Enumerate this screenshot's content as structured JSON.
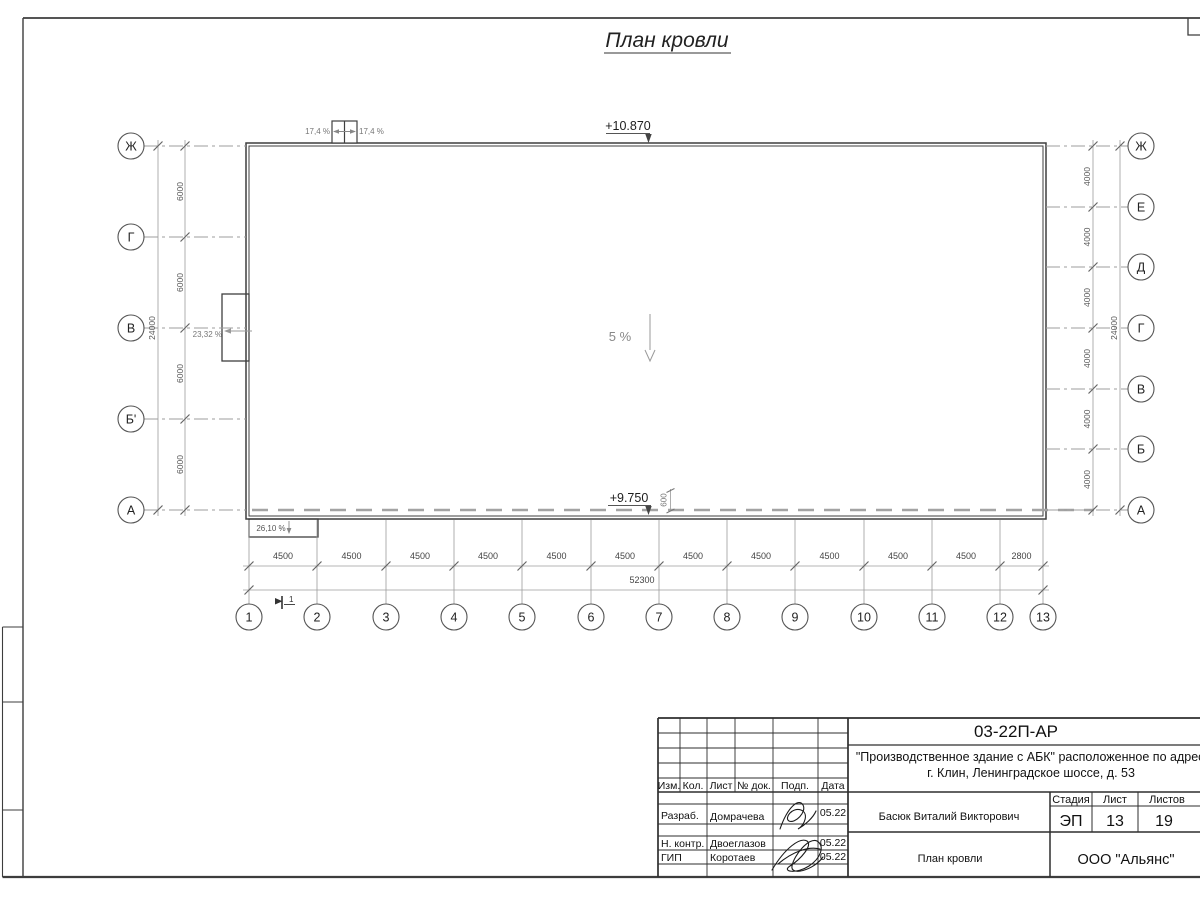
{
  "page_title": "План кровли",
  "plan": {
    "elevations": {
      "roof_top": "+10.870",
      "roof_low": "+9.750"
    },
    "slopes": {
      "hatch_left": "17,4 %",
      "hatch_right": "17,4 %",
      "west_wall": "23,32 %",
      "canopy": "26,10 %",
      "main_roof": "5 %"
    },
    "parapet_dim": "600",
    "section_mark": "1",
    "grid": {
      "bottom_axes": [
        "1",
        "2",
        "3",
        "4",
        "5",
        "6",
        "7",
        "8",
        "9",
        "10",
        "11",
        "12",
        "13"
      ],
      "left_axes": [
        "Ж",
        "Г",
        "В",
        "Б'",
        "А"
      ],
      "right_axes": [
        "Ж",
        "Е",
        "Д",
        "Г",
        "В",
        "Б",
        "А"
      ],
      "bottom_dims": [
        "4500",
        "4500",
        "4500",
        "4500",
        "4500",
        "4500",
        "4500",
        "4500",
        "4500",
        "4500",
        "4500",
        "2800"
      ],
      "bottom_total": "52300",
      "left_dims": [
        "6000",
        "6000",
        "6000",
        "6000"
      ],
      "left_total": "24000",
      "right_dims": [
        "4000",
        "4000",
        "4000",
        "4000",
        "4000",
        "4000"
      ],
      "right_total": "24000"
    }
  },
  "title_block": {
    "doc_number": "03-22П-АР",
    "project_line1": "\"Производственное здание с АБК\" расположенное по адресу:",
    "project_line2": "г. Клин, Ленинградское шоссе, д. 53",
    "header_cols": [
      "Изм.",
      "Кол.",
      "Лист",
      "№ док.",
      "Подп.",
      "Дата"
    ],
    "rows": [
      {
        "role": "Разраб.",
        "name": "Домрачева",
        "date": "05.22"
      },
      {
        "role": "Н. контр.",
        "name": "Двоеглазов",
        "date": "05.22"
      },
      {
        "role": "ГИП",
        "name": "Коротаев",
        "date": "05.22"
      }
    ],
    "approver": "Басюк Виталий Викторович",
    "stage_label": "Стадия",
    "sheet_label": "Лист",
    "sheets_label": "Листов",
    "stage": "ЭП",
    "sheet": "13",
    "sheets": "19",
    "drawing_name": "План кровли",
    "company": "ООО \"Альянс\""
  }
}
